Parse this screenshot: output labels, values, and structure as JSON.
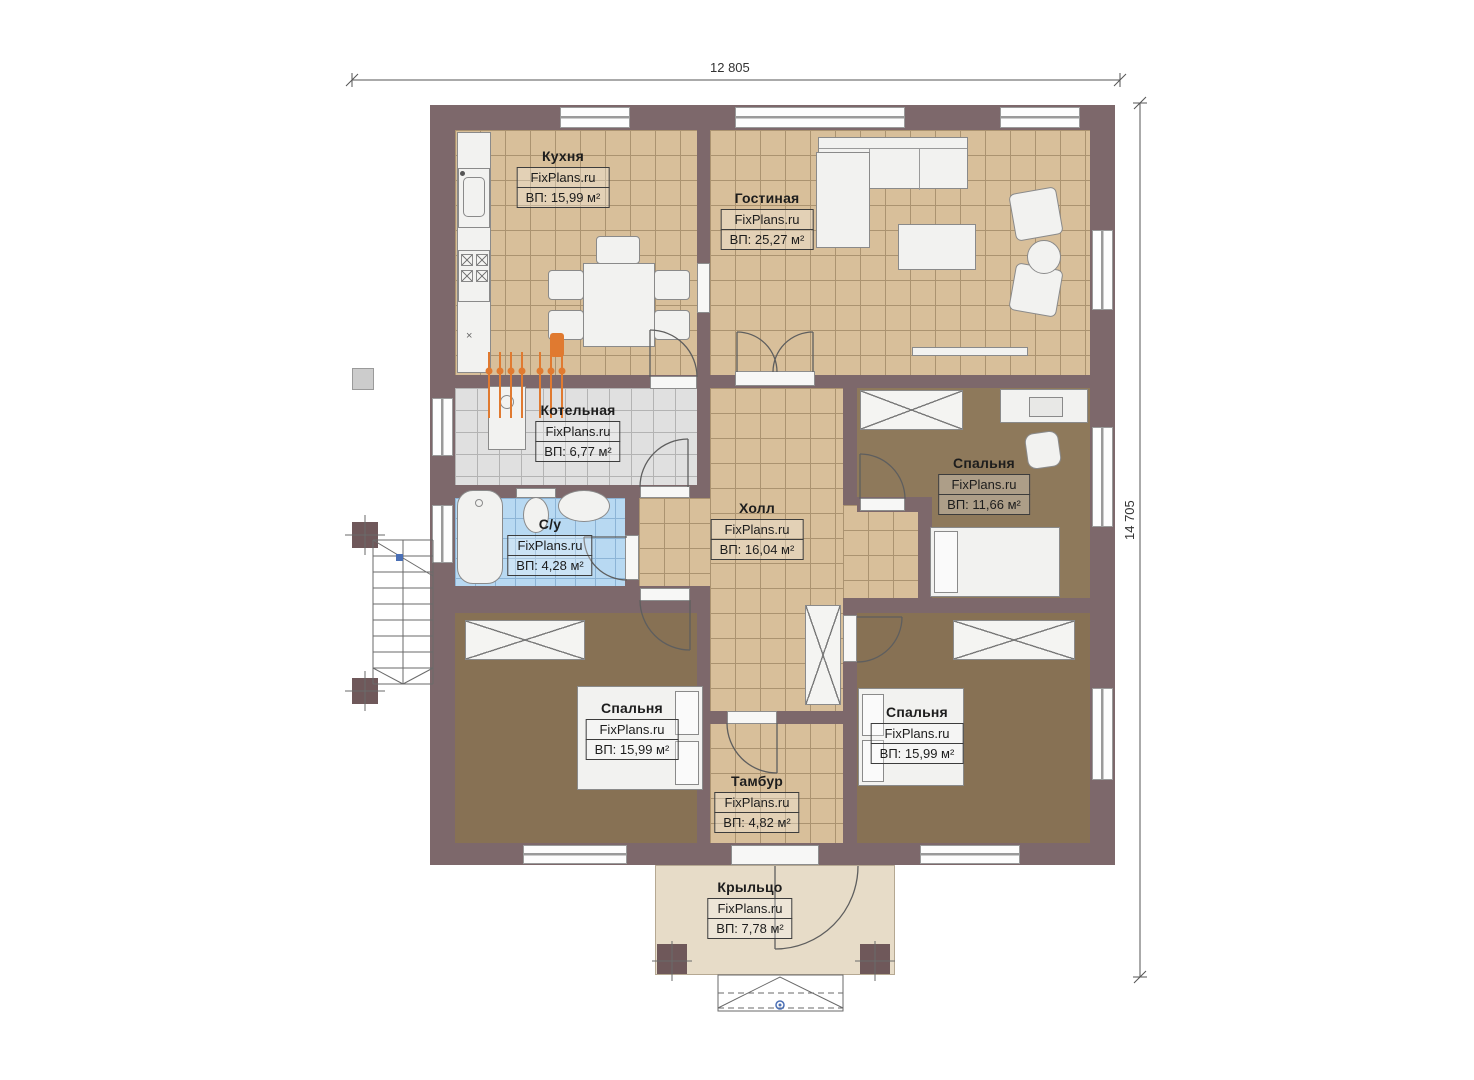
{
  "plan": {
    "source_brand": "FixPlans.ru",
    "dimensions": {
      "width_label": "12 805",
      "height_label": "14 705"
    },
    "kitchen_counter_mark": "×"
  },
  "rooms": [
    {
      "id": "kitchen",
      "name": "Кухня",
      "brand": "FixPlans.ru",
      "area": "ВП: 15,99 м²"
    },
    {
      "id": "living",
      "name": "Гостиная",
      "brand": "FixPlans.ru",
      "area": "ВП: 25,27 м²"
    },
    {
      "id": "boiler",
      "name": "Котельная",
      "brand": "FixPlans.ru",
      "area": "ВП: 6,77 м²"
    },
    {
      "id": "bathroom",
      "name": "С/у",
      "brand": "FixPlans.ru",
      "area": "ВП: 4,28 м²"
    },
    {
      "id": "hall",
      "name": "Холл",
      "brand": "FixPlans.ru",
      "area": "ВП: 16,04 м²"
    },
    {
      "id": "bedroom-tr",
      "name": "Спальня",
      "brand": "FixPlans.ru",
      "area": "ВП: 11,66 м²"
    },
    {
      "id": "bedroom-bl",
      "name": "Спальня",
      "brand": "FixPlans.ru",
      "area": "ВП: 15,99 м²"
    },
    {
      "id": "bedroom-br",
      "name": "Спальня",
      "brand": "FixPlans.ru",
      "area": "ВП: 15,99 м²"
    },
    {
      "id": "vestibule",
      "name": "Тамбур",
      "brand": "FixPlans.ru",
      "area": "ВП: 4,82 м²"
    },
    {
      "id": "porch",
      "name": "Крыльцо",
      "brand": "FixPlans.ru",
      "area": "ВП: 7,78 м²"
    }
  ],
  "colors": {
    "wall": "#7d686b",
    "tile_tan": "#d8bf9a",
    "tile_gray": "#e0e0e0",
    "tile_blue": "#b8d9f2",
    "carpet": "#877154",
    "porch_floor": "#e7dcc8",
    "pipes_orange": "#e07a30",
    "marker_blue": "#4a6fb5"
  }
}
